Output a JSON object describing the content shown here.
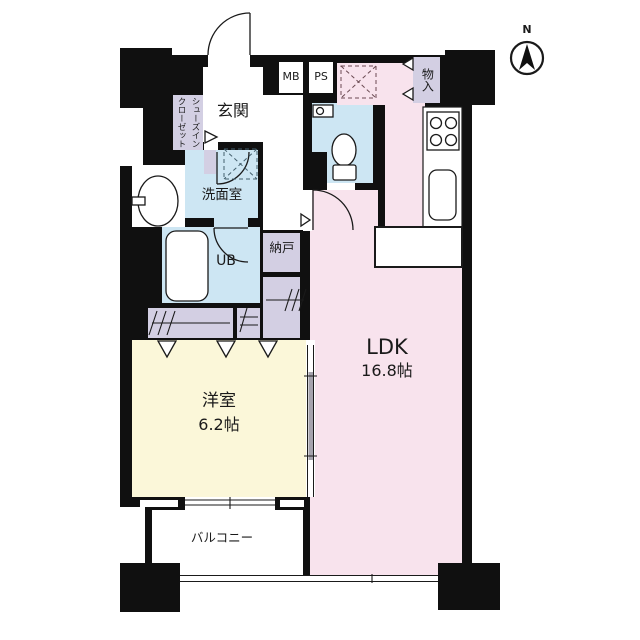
{
  "compass": {
    "label": "N"
  },
  "rooms": {
    "ldk": {
      "name": "LDK",
      "size": "16.8帖"
    },
    "bedroom": {
      "name": "洋室",
      "size": "6.2帖"
    },
    "balcony": {
      "name": "バルコニー"
    },
    "entrance": {
      "name": "玄関"
    },
    "shoes_closet": {
      "name": "シューズインクローゼット"
    },
    "washroom": {
      "name": "洗面室"
    },
    "bath": {
      "name": "UB"
    },
    "storage": {
      "name": "納戸"
    },
    "closet_top": {
      "name": "物入"
    },
    "meter_box": {
      "name": "MB"
    },
    "pipe_space": {
      "name": "PS"
    }
  },
  "colors": {
    "ldk_pink": "#f8e3ed",
    "bedroom_yellow": "#fbf7d9",
    "wet_area_blue": "#cde6f3",
    "storage_lavender": "#d3cfe3",
    "wall_black": "#101010"
  }
}
